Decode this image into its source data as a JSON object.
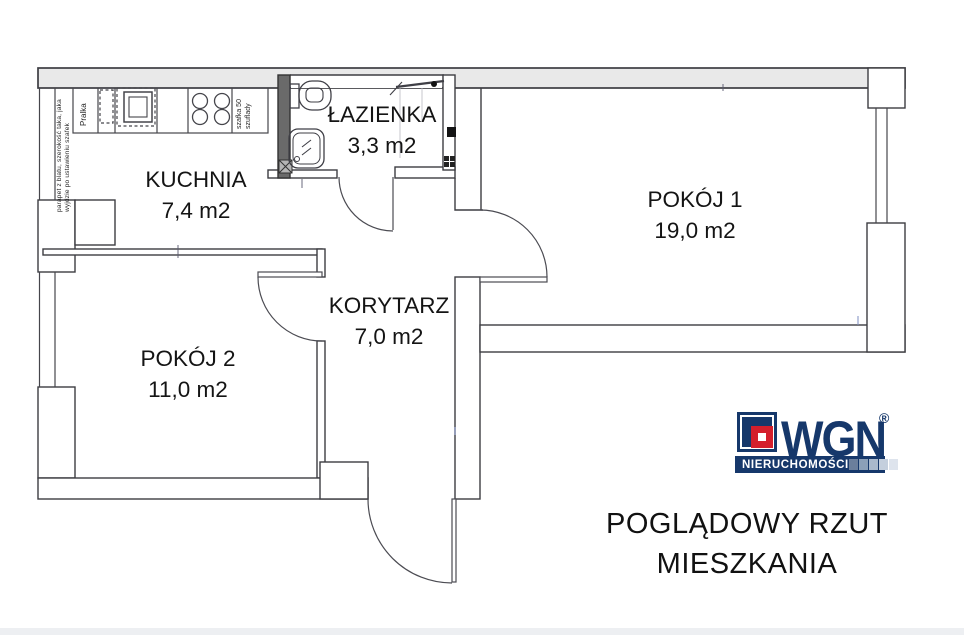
{
  "floorplan": {
    "rooms": [
      {
        "id": "kuchnia",
        "name": "KUCHNIA",
        "area": "7,4 m2"
      },
      {
        "id": "lazienka",
        "name": "ŁAZIENKA",
        "area": "3,3 m2"
      },
      {
        "id": "pokoj1",
        "name": "POKÓJ 1",
        "area": "19,0 m2"
      },
      {
        "id": "korytarz",
        "name": "KORYTARZ",
        "area": "7,0 m2"
      },
      {
        "id": "pokoj2",
        "name": "POKÓJ 2",
        "area": "11,0 m2"
      }
    ],
    "annotations": {
      "window_note_line1": "parapet z blatu, szerokość taka, jaka",
      "window_note_line2": "wyjdzie po ustawieniu szafek",
      "washing_machine": "Pralka",
      "cabinet_note_line1": "szafka 50",
      "cabinet_note_line2": "szuflady"
    }
  },
  "logo": {
    "brand": "WGN",
    "registered_mark": "®",
    "tagline": "NIERUCHOMOŚCI",
    "colors": {
      "navy": "#16386b",
      "red": "#d41f2c"
    }
  },
  "caption": {
    "line1": "POGLĄDOWY RZUT",
    "line2": "MIESZKANIA"
  }
}
